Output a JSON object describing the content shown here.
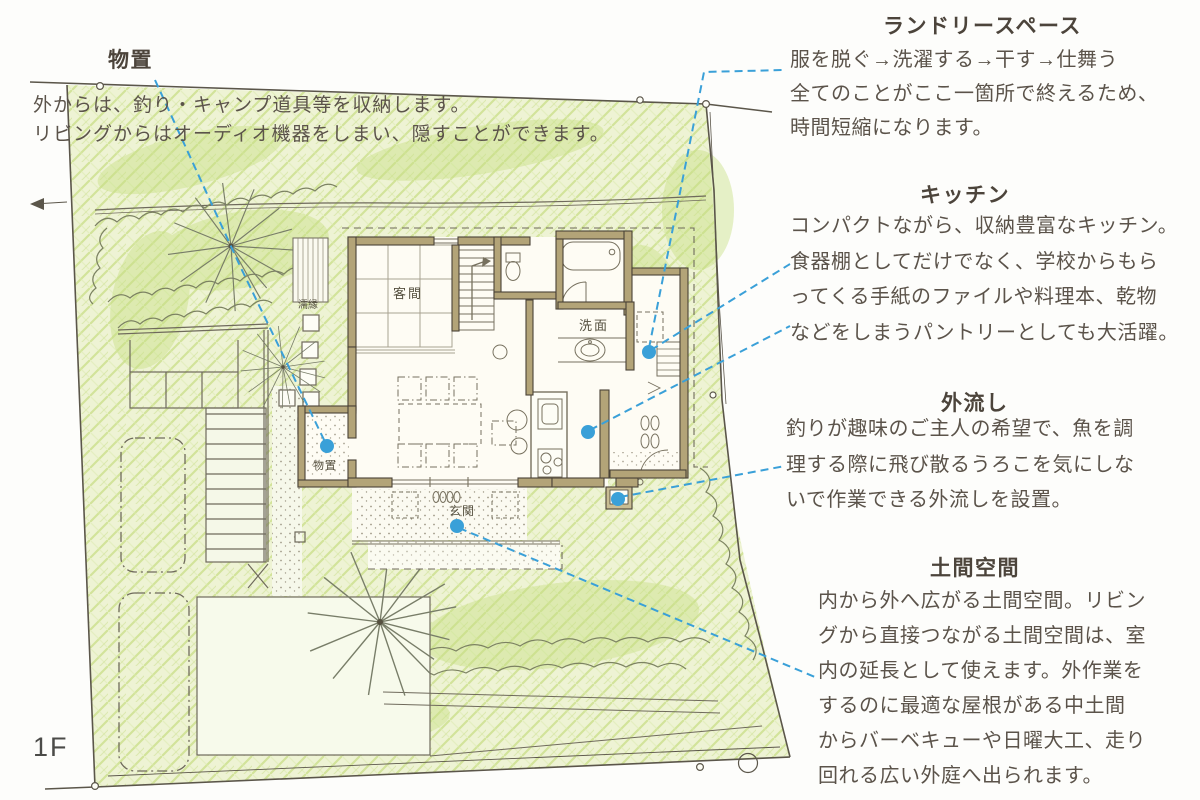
{
  "floor_label": "1F",
  "colors": {
    "accent_blue": "#3aa0d8",
    "lawn_green": "#cade8c",
    "wall_tan": "#b3a478",
    "text_brown": "#5b534a"
  },
  "plan_labels": {
    "guest_room": "客間",
    "washroom": "洗面",
    "storage_room": "物置",
    "entrance": "玄関",
    "veranda": "濡縁"
  },
  "annotations": {
    "storage": {
      "title": "物置",
      "body": "外からは、釣り・キャンプ道具等を収納します。\nリビングからはオーディオ機器をしまい、隠すことができます。"
    },
    "laundry": {
      "title": "ランドリースペース",
      "body": "服を脱ぐ→洗濯する→干す→仕舞う\n全てのことがここ一箇所で終えるため、\n時間短縮になります。"
    },
    "kitchen": {
      "title": "キッチン",
      "body": "コンパクトながら、収納豊富なキッチン。\n食器棚としてだけでなく、学校からもら\nってくる手紙のファイルや料理本、乾物\nなどをしまうパントリーとしても大活躍。"
    },
    "outdoor_sink": {
      "title": "外流し",
      "body": "釣りが趣味のご主人の希望で、魚を調\n理する際に飛び散るうろこを気にしな\nいで作業できる外流しを設置。"
    },
    "doma": {
      "title": "土間空間",
      "body": "内から外へ広がる土間空間。リビン\nグから直接つながる土間空間は、室\n内の延長として使えます。外作業を\nするのに最適な屋根がある中土間\nからバーベキューや日曜大工、走り\n回れる広い外庭へ出られます。"
    }
  }
}
